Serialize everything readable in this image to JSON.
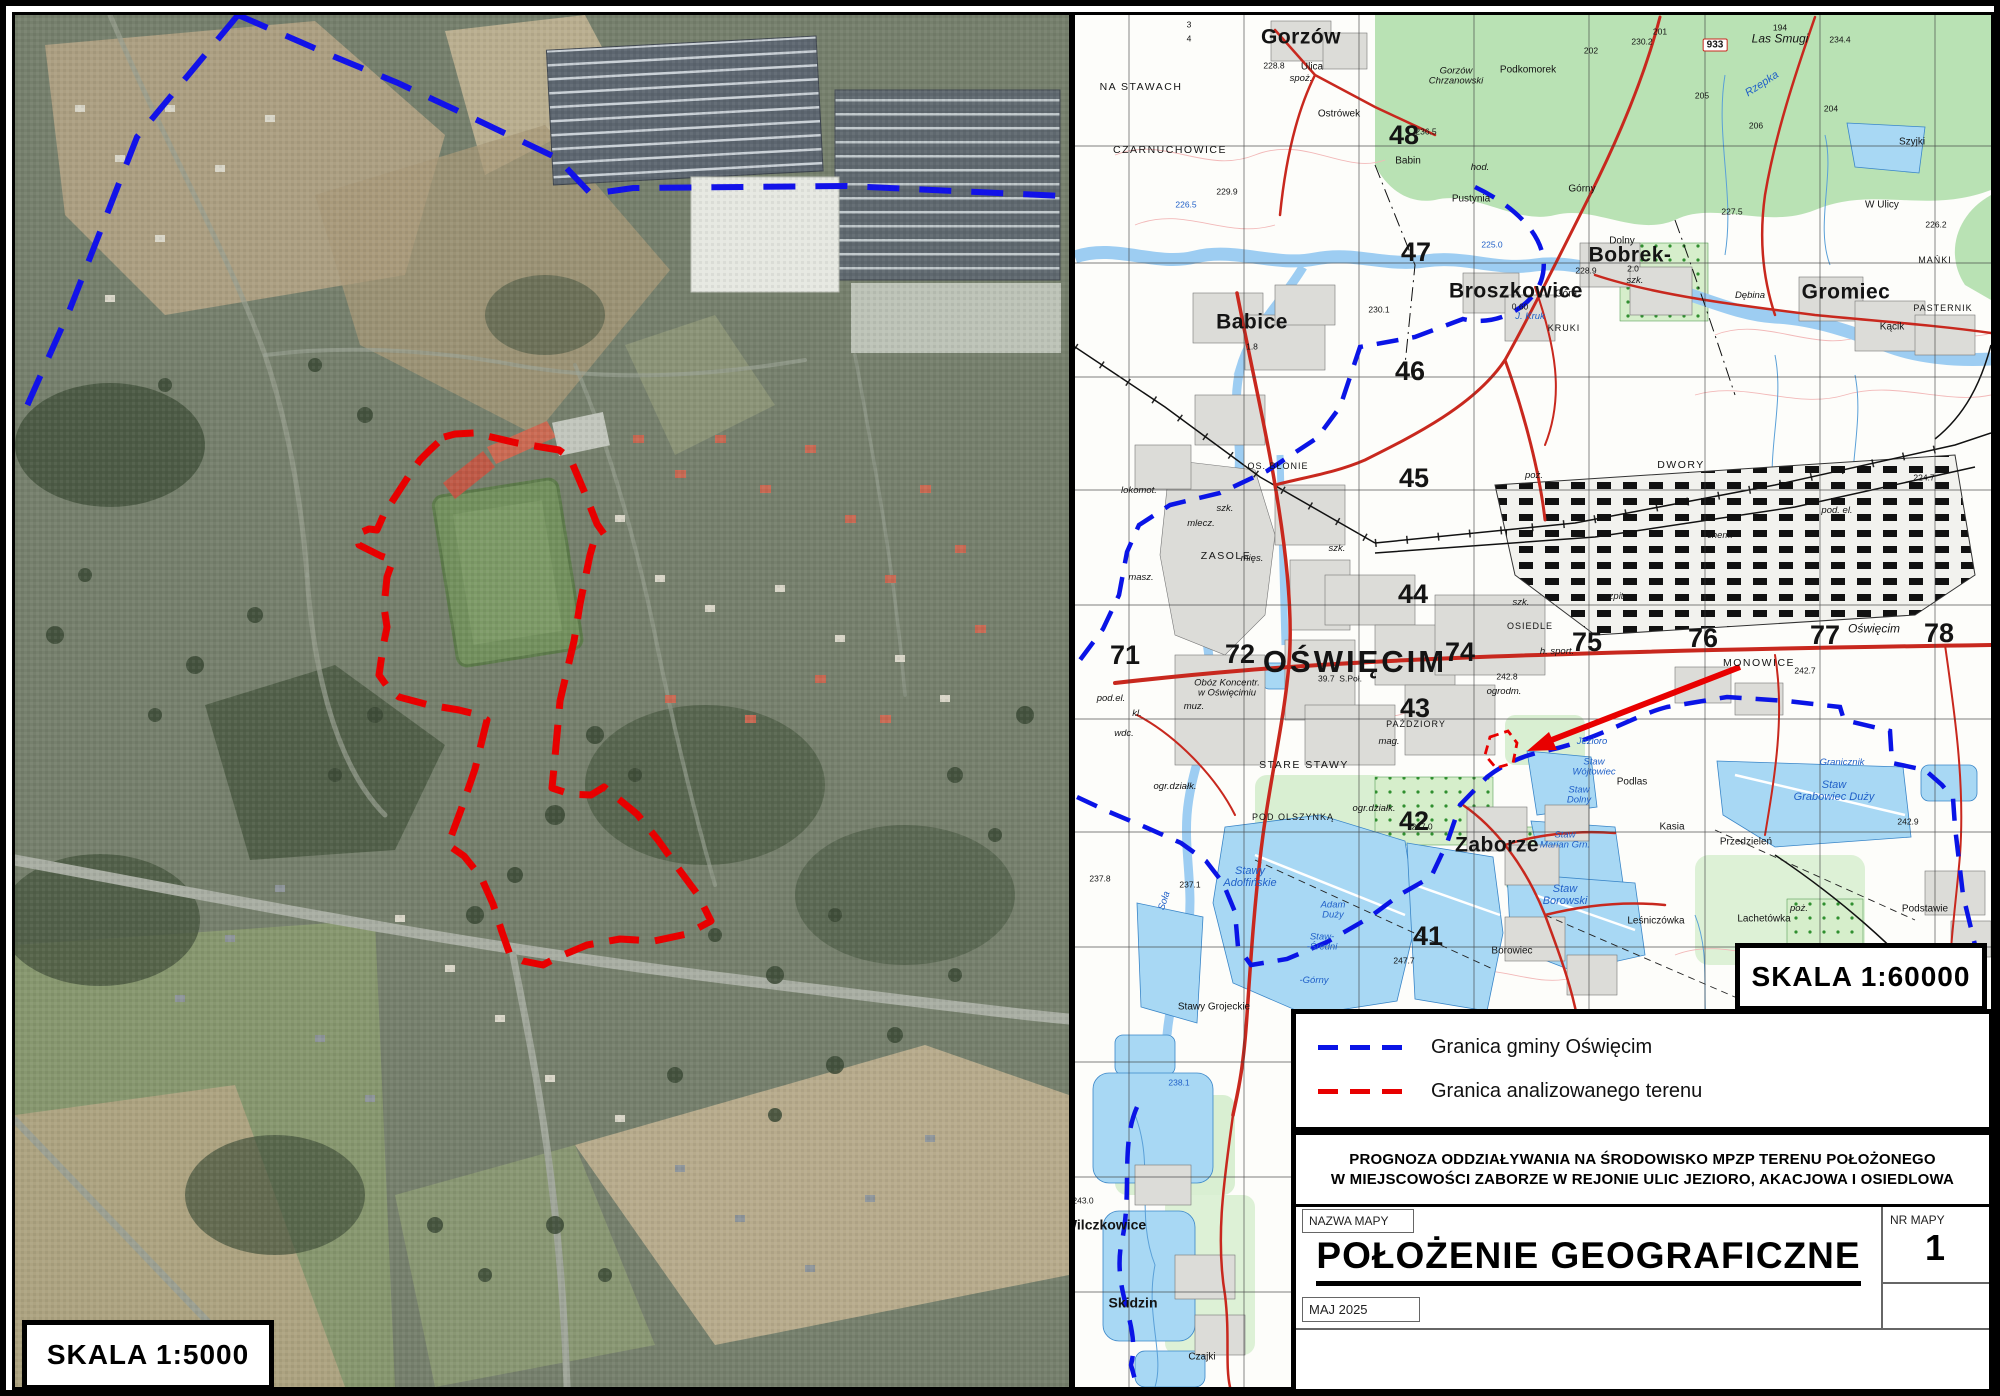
{
  "page": {
    "type": "map-sheet",
    "language": "pl"
  },
  "aerial_panel": {
    "scale_label": "SKALA 1:5000"
  },
  "topo_panel": {
    "scale_label": "SKALA 1:60000",
    "labels": [
      {
        "t": "48",
        "x": 329,
        "y": 121,
        "c": "grid"
      },
      {
        "t": "47",
        "x": 341,
        "y": 238,
        "c": "grid"
      },
      {
        "t": "46",
        "x": 335,
        "y": 357,
        "c": "grid"
      },
      {
        "t": "45",
        "x": 339,
        "y": 464,
        "c": "grid"
      },
      {
        "t": "44",
        "x": 338,
        "y": 580,
        "c": "grid"
      },
      {
        "t": "43",
        "x": 340,
        "y": 694,
        "c": "grid"
      },
      {
        "t": "42",
        "x": 339,
        "y": 807,
        "c": "grid"
      },
      {
        "t": "41",
        "x": 353,
        "y": 922,
        "c": "grid"
      },
      {
        "t": "71",
        "x": 50,
        "y": 641,
        "c": "grid"
      },
      {
        "t": "72",
        "x": 165,
        "y": 640,
        "c": "grid"
      },
      {
        "t": "74",
        "x": 385,
        "y": 638,
        "c": "grid"
      },
      {
        "t": "75",
        "x": 512,
        "y": 628,
        "c": "grid"
      },
      {
        "t": "76",
        "x": 628,
        "y": 624,
        "c": "grid"
      },
      {
        "t": "77",
        "x": 750,
        "y": 621,
        "c": "grid"
      },
      {
        "t": "78",
        "x": 864,
        "y": 619,
        "c": "grid"
      },
      {
        "t": "OŚWIĘCIM",
        "x": 280,
        "y": 647,
        "c": "city"
      },
      {
        "t": "Babice",
        "x": 177,
        "y": 307,
        "c": "town"
      },
      {
        "t": "Broszkowice",
        "x": 441,
        "y": 276,
        "c": "town"
      },
      {
        "t": "Bobrek-",
        "x": 555,
        "y": 240,
        "c": "town"
      },
      {
        "t": "Gromiec",
        "x": 771,
        "y": 277,
        "c": "town"
      },
      {
        "t": "Zaborze",
        "x": 422,
        "y": 830,
        "c": "town"
      },
      {
        "t": "Gorzów",
        "x": 226,
        "y": 22,
        "c": "town"
      },
      {
        "t": "Wilczkowice",
        "x": 30,
        "y": 1210,
        "c": "town2"
      },
      {
        "t": "Skidzin",
        "x": 58,
        "y": 1288,
        "c": "town2"
      },
      {
        "t": "Czajki",
        "x": 127,
        "y": 1342,
        "c": "med"
      },
      {
        "t": "NA STAWACH",
        "x": 66,
        "y": 73,
        "c": "caps"
      },
      {
        "t": "CZARNUCHOWICE",
        "x": 95,
        "y": 136,
        "c": "caps"
      },
      {
        "t": "Podkomorek",
        "x": 453,
        "y": 55,
        "c": "med"
      },
      {
        "t": "Gorzów\nChrzanowski",
        "x": 381,
        "y": 62,
        "c": "ital"
      },
      {
        "t": "Las Smugi",
        "x": 705,
        "y": 24,
        "c": "itall"
      },
      {
        "t": "Rzepka",
        "x": 687,
        "y": 69,
        "c": "blueital",
        "r": -33
      },
      {
        "t": "Ostrówek",
        "x": 264,
        "y": 99,
        "c": "med"
      },
      {
        "t": "Ulica",
        "x": 237,
        "y": 52,
        "c": "med"
      },
      {
        "t": "spoż.",
        "x": 226,
        "y": 64,
        "c": "ital"
      },
      {
        "t": "Babin",
        "x": 333,
        "y": 146,
        "c": "med"
      },
      {
        "t": "hod.",
        "x": 405,
        "y": 153,
        "c": "ital"
      },
      {
        "t": "Pustynia",
        "x": 396,
        "y": 184,
        "c": "med"
      },
      {
        "t": "Górny",
        "x": 507,
        "y": 174,
        "c": "med"
      },
      {
        "t": "Dolny",
        "x": 547,
        "y": 226,
        "c": "med"
      },
      {
        "t": "Góra",
        "x": 491,
        "y": 279,
        "c": "med"
      },
      {
        "t": "Szyjki",
        "x": 837,
        "y": 127,
        "c": "med"
      },
      {
        "t": "W Ulicy",
        "x": 807,
        "y": 190,
        "c": "med"
      },
      {
        "t": "Dębina",
        "x": 675,
        "y": 281,
        "c": "ital"
      },
      {
        "t": "MAŃKI",
        "x": 860,
        "y": 246,
        "c": "capsm"
      },
      {
        "t": "PASTERNIK",
        "x": 868,
        "y": 294,
        "c": "capsm"
      },
      {
        "t": "Kącik",
        "x": 817,
        "y": 312,
        "c": "med"
      },
      {
        "t": "KRUKI",
        "x": 489,
        "y": 314,
        "c": "capsm"
      },
      {
        "t": "J. Kruk",
        "x": 455,
        "y": 302,
        "c": "blueitalsm"
      },
      {
        "t": "DWORY",
        "x": 606,
        "y": 451,
        "c": "caps"
      },
      {
        "t": "MONOWICE",
        "x": 684,
        "y": 649,
        "c": "caps"
      },
      {
        "t": "OSIEDLE",
        "x": 455,
        "y": 612,
        "c": "capsm"
      },
      {
        "t": "ZASOLE",
        "x": 151,
        "y": 542,
        "c": "caps"
      },
      {
        "t": "OS. BŁONIE",
        "x": 203,
        "y": 452,
        "c": "capsm"
      },
      {
        "t": "STARE STAWY",
        "x": 229,
        "y": 751,
        "c": "caps"
      },
      {
        "t": "PAŹDZIORY",
        "x": 341,
        "y": 710,
        "c": "capsm"
      },
      {
        "t": "POD OLSZYNKĄ",
        "x": 218,
        "y": 803,
        "c": "capsm"
      },
      {
        "t": "lokomot.",
        "x": 64,
        "y": 476,
        "c": "ital"
      },
      {
        "t": "masz.",
        "x": 66,
        "y": 563,
        "c": "ital"
      },
      {
        "t": "mlecz.",
        "x": 126,
        "y": 509,
        "c": "ital"
      },
      {
        "t": "mięs.",
        "x": 177,
        "y": 544,
        "c": "ital"
      },
      {
        "t": "muz.",
        "x": 119,
        "y": 692,
        "c": "ital"
      },
      {
        "t": "mag.",
        "x": 314,
        "y": 727,
        "c": "ital"
      },
      {
        "t": "wdc.",
        "x": 49,
        "y": 719,
        "c": "ital"
      },
      {
        "t": "pod.el.",
        "x": 36,
        "y": 684,
        "c": "ital"
      },
      {
        "t": "kl.",
        "x": 62,
        "y": 699,
        "c": "ital"
      },
      {
        "t": "szpit.",
        "x": 540,
        "y": 582,
        "c": "ital"
      },
      {
        "t": "chem.",
        "x": 645,
        "y": 521,
        "c": "ital"
      },
      {
        "t": "pod. el.",
        "x": 762,
        "y": 496,
        "c": "ital"
      },
      {
        "t": "Oświęcim",
        "x": 799,
        "y": 614,
        "c": "itall"
      },
      {
        "t": "h. sport.",
        "x": 482,
        "y": 637,
        "c": "ital"
      },
      {
        "t": "szk.",
        "x": 150,
        "y": 494,
        "c": "ital"
      },
      {
        "t": "szk.",
        "x": 262,
        "y": 534,
        "c": "ital"
      },
      {
        "t": "szk.",
        "x": 446,
        "y": 588,
        "c": "ital"
      },
      {
        "t": "szk.",
        "x": 560,
        "y": 266,
        "c": "ital"
      },
      {
        "t": "poż.",
        "x": 459,
        "y": 461,
        "c": "ital"
      },
      {
        "t": "poż.",
        "x": 724,
        "y": 894,
        "c": "ital"
      },
      {
        "t": "ogrodm.",
        "x": 429,
        "y": 677,
        "c": "ital"
      },
      {
        "t": "ogr.działk.",
        "x": 100,
        "y": 772,
        "c": "ital"
      },
      {
        "t": "ogr.działk.",
        "x": 299,
        "y": 794,
        "c": "ital"
      },
      {
        "t": "Obóz Koncentr.\nw Oświęcimiu",
        "x": 152,
        "y": 674,
        "c": "ital"
      },
      {
        "t": "39.7  S.Poł.",
        "x": 265,
        "y": 664,
        "c": "elev"
      },
      {
        "t": "Stawy\nAdolfińskie",
        "x": 175,
        "y": 862,
        "c": "blueital"
      },
      {
        "t": "Adam\nDuży",
        "x": 258,
        "y": 896,
        "c": "blueitalsm"
      },
      {
        "t": "Staw-\n-Średni",
        "x": 247,
        "y": 928,
        "c": "blueitalsm"
      },
      {
        "t": "-Górny",
        "x": 239,
        "y": 966,
        "c": "blueitalsm"
      },
      {
        "t": "Stawy Grojeckie",
        "x": 139,
        "y": 992,
        "c": "med"
      },
      {
        "t": "Staw-",
        "x": 322,
        "y": 1029,
        "c": "blueitalsm"
      },
      {
        "t": "Staw\nBorowski",
        "x": 490,
        "y": 880,
        "c": "blueital"
      },
      {
        "t": "Staw\nWójtowiec",
        "x": 519,
        "y": 753,
        "c": "blueitalsm"
      },
      {
        "t": "Staw\nDolny",
        "x": 504,
        "y": 781,
        "c": "blueitalsm"
      },
      {
        "t": "Staw\nMarian Grn.",
        "x": 490,
        "y": 826,
        "c": "blueitalsm"
      },
      {
        "t": "Jezioro",
        "x": 517,
        "y": 727,
        "c": "blueitalsm"
      },
      {
        "t": "Staw\nGrabowiec Duży",
        "x": 759,
        "y": 776,
        "c": "blueital"
      },
      {
        "t": "Granicznik",
        "x": 767,
        "y": 748,
        "c": "blueitalsm"
      },
      {
        "t": "Podlas",
        "x": 557,
        "y": 767,
        "c": "med"
      },
      {
        "t": "Kasia",
        "x": 597,
        "y": 812,
        "c": "med"
      },
      {
        "t": "Przedzieleń",
        "x": 671,
        "y": 827,
        "c": "med"
      },
      {
        "t": "Leśniczówka",
        "x": 581,
        "y": 906,
        "c": "med"
      },
      {
        "t": "Lachetówka",
        "x": 689,
        "y": 904,
        "c": "med"
      },
      {
        "t": "Podstawie",
        "x": 850,
        "y": 894,
        "c": "med"
      },
      {
        "t": "Borowiec",
        "x": 437,
        "y": 936,
        "c": "med"
      },
      {
        "t": "Soła",
        "x": 90,
        "y": 886,
        "c": "blueitalsm",
        "r": -72
      },
      {
        "t": "933",
        "x": 640,
        "y": 30,
        "c": "badge"
      },
      {
        "t": "230.2",
        "x": 567,
        "y": 27,
        "c": "elev"
      },
      {
        "t": "201",
        "x": 585,
        "y": 17,
        "c": "elev"
      },
      {
        "t": "202",
        "x": 516,
        "y": 36,
        "c": "elev"
      },
      {
        "t": "194",
        "x": 705,
        "y": 13,
        "c": "elev"
      },
      {
        "t": "234.4",
        "x": 765,
        "y": 25,
        "c": "elev"
      },
      {
        "t": "205",
        "x": 627,
        "y": 81,
        "c": "elev"
      },
      {
        "t": "206",
        "x": 681,
        "y": 111,
        "c": "elev"
      },
      {
        "t": "204",
        "x": 756,
        "y": 94,
        "c": "elev"
      },
      {
        "t": "227.5",
        "x": 657,
        "y": 197,
        "c": "elev"
      },
      {
        "t": "226.2",
        "x": 861,
        "y": 210,
        "c": "elev"
      },
      {
        "t": "225.0",
        "x": 417,
        "y": 230,
        "c": "blueelev"
      },
      {
        "t": "226.5",
        "x": 111,
        "y": 190,
        "c": "blueelev"
      },
      {
        "t": "229.9",
        "x": 152,
        "y": 177,
        "c": "elev"
      },
      {
        "t": "228.8",
        "x": 199,
        "y": 51,
        "c": "elev"
      },
      {
        "t": "236.5",
        "x": 351,
        "y": 117,
        "c": "elev"
      },
      {
        "t": "230.1",
        "x": 304,
        "y": 295,
        "c": "elev"
      },
      {
        "t": "228.9",
        "x": 511,
        "y": 256,
        "c": "elev"
      },
      {
        "t": "242.8",
        "x": 432,
        "y": 662,
        "c": "elev"
      },
      {
        "t": "242.7",
        "x": 730,
        "y": 656,
        "c": "elev"
      },
      {
        "t": "242.9",
        "x": 833,
        "y": 807,
        "c": "elev"
      },
      {
        "t": "224.7",
        "x": 849,
        "y": 463,
        "c": "elev"
      },
      {
        "t": "247.0",
        "x": 347,
        "y": 812,
        "c": "elev"
      },
      {
        "t": "247.7",
        "x": 329,
        "y": 946,
        "c": "elev"
      },
      {
        "t": "237.8",
        "x": 25,
        "y": 864,
        "c": "elev"
      },
      {
        "t": "237.1",
        "x": 115,
        "y": 870,
        "c": "elev"
      },
      {
        "t": "238.1",
        "x": 104,
        "y": 1068,
        "c": "blueelev"
      },
      {
        "t": "243.0",
        "x": 8,
        "y": 1186,
        "c": "elev"
      },
      {
        "t": "1.8",
        "x": 177,
        "y": 332,
        "c": "elev"
      },
      {
        "t": "0.60",
        "x": 445,
        "y": 292,
        "c": "elev"
      },
      {
        "t": "2.0",
        "x": 558,
        "y": 254,
        "c": "elev"
      },
      {
        "t": "3",
        "x": 114,
        "y": 10,
        "c": "elev"
      },
      {
        "t": "4",
        "x": 114,
        "y": 24,
        "c": "elev"
      }
    ]
  },
  "legend": {
    "items": [
      {
        "label": "Granica gminy Oświęcim",
        "color": "#0a14e6",
        "style": "dashed"
      },
      {
        "label": "Granica analizowanego terenu",
        "color": "#e80000",
        "style": "dashed"
      }
    ]
  },
  "title_block": {
    "project_title_line1": "PROGNOZA ODDZIAŁYWANIA NA ŚRODOWISKO MPZP TERENU POŁOŻONEGO",
    "project_title_line2": "W MIEJSCOWOŚCI ZABORZE W REJONIE ULIC JEZIORO, AKACJOWA I OSIEDLOWA",
    "field_label_map_name": "NAZWA MAPY",
    "map_name": "POŁOŻENIE GEOGRAFICZNE",
    "field_label_map_number": "NR MAPY",
    "map_number": "1",
    "date": "MAJ 2025"
  },
  "colors": {
    "gmina_boundary": "#0a14e6",
    "analyzed_area_boundary": "#e80000",
    "water": "#a8d8f4",
    "forest": "#b9e2b4",
    "road": "#c8281e"
  }
}
